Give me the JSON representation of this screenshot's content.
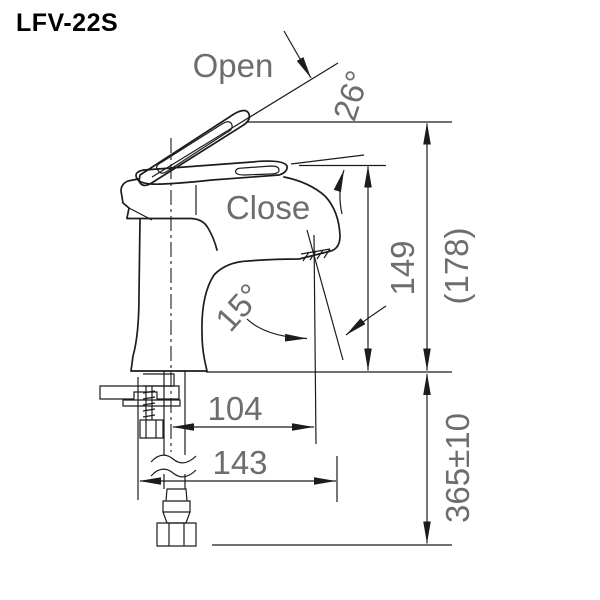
{
  "title": "LFV-22S",
  "labels": {
    "open": "Open",
    "close": "Close"
  },
  "dimensions": {
    "open_angle": "26°",
    "spout_angle": "15°",
    "spout_height": "149",
    "open_handle_height": "(178)",
    "spout_reach": "104",
    "total_reach": "143",
    "hose_length": "365±10"
  },
  "colors": {
    "line": "#1c1c1c",
    "dimension_text": "#6d6d6d",
    "title_text": "#000000",
    "background": "#ffffff"
  }
}
